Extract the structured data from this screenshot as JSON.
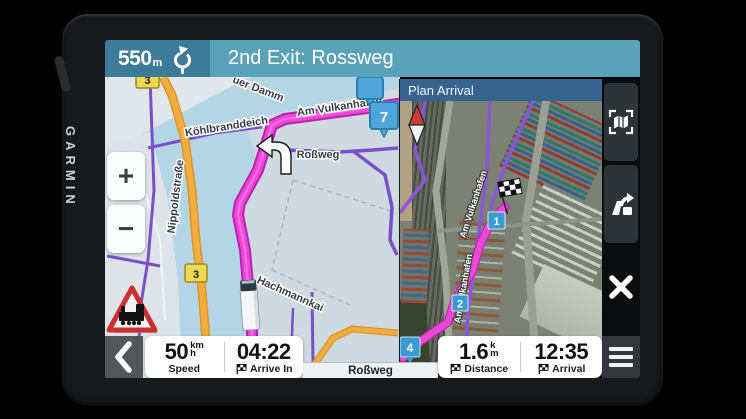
{
  "device": {
    "brand": "GARMIN"
  },
  "nav_bar": {
    "distance_value": "550",
    "distance_unit": "m",
    "instruction": "2nd Exit: Rossweg"
  },
  "map": {
    "zoom_in_label": "+",
    "zoom_out_label": "−",
    "shield_top": "3",
    "shield_bottom": "3",
    "exit_marker": "7",
    "labels": {
      "damm": "uer Damm",
      "koehlbranddeich": "Köhlbranddeich",
      "am_vulkanhafen": "Am Vulkanhafen",
      "rossweg": "Roßweg",
      "nippoldstrasse": "Nippoldstraße",
      "hachmannkai": "Hachmannkai"
    }
  },
  "plan_arrival": {
    "title": "Plan Arrival",
    "street_label_1": "Am Vulkanhafen",
    "street_label_2": "Am Vulkanhafen",
    "marker_1": "1",
    "marker_2": "2",
    "marker_4": "4"
  },
  "status_bar": {
    "speed_value": "50",
    "speed_unit_top": "km",
    "speed_unit_bottom": "h",
    "speed_label": "Speed",
    "arrive_in_value": "04:22",
    "arrive_in_label": "Arrive In",
    "street_name": "Roßweg",
    "distance_value": "1.6",
    "distance_unit_top": "k",
    "distance_unit_bottom": "m",
    "distance_label": "Distance",
    "arrival_value": "12:35",
    "arrival_label": "Arrival"
  },
  "colors": {
    "nav_bar_left_bg": "#3d7c99",
    "nav_bar_right_bg": "#5aa2b8",
    "plan_arrival_header_bg": "#36648e",
    "route_magenta": "#ee46d8",
    "road_orange": "#f3ac3e",
    "road_purple": "#7a4fc9",
    "marker_blue": "#4fa5d9",
    "shield_yellow": "#ecd94f"
  }
}
